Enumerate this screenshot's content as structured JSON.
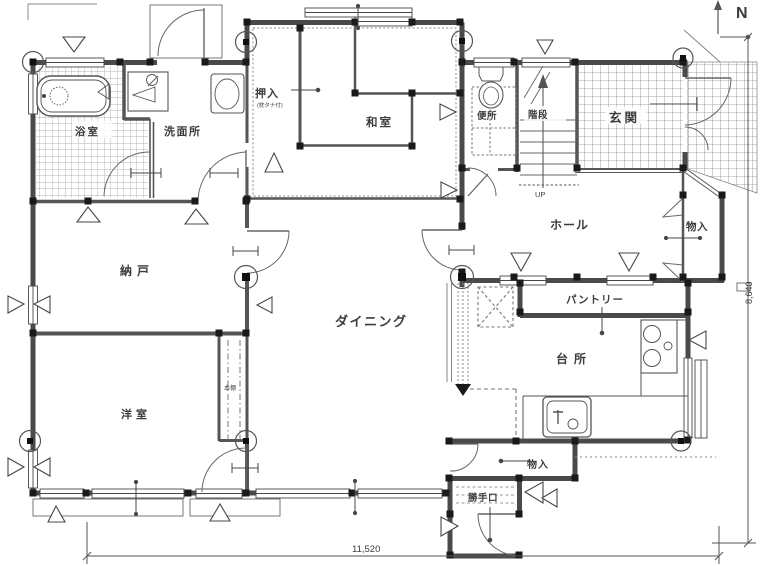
{
  "plan_title": "floor-plan",
  "north_label": "N",
  "rooms": {
    "bath": {
      "label": "浴室"
    },
    "washroom": {
      "label": "洗面所"
    },
    "oshiire": {
      "label": "押入"
    },
    "oshiire_note": {
      "label": "(枕タナ付)"
    },
    "washitsu": {
      "label": "和室"
    },
    "toilet": {
      "label": "便所"
    },
    "stairs": {
      "label": "階段"
    },
    "stairs_up": {
      "label": "UP"
    },
    "genkan": {
      "label": "玄関"
    },
    "hall": {
      "label": "ホール"
    },
    "storage_right": {
      "label": "物入"
    },
    "nando": {
      "label": "納戸"
    },
    "dining": {
      "label": "ダイニング"
    },
    "pantry": {
      "label": "パントリー"
    },
    "kitchen": {
      "label": "台所"
    },
    "yoshitsu": {
      "label": "洋室"
    },
    "bookshelf": {
      "label": "本棚"
    },
    "storage_bottom": {
      "label": "物入"
    },
    "backdoor": {
      "label": "勝手口"
    }
  },
  "dimensions": {
    "width_mm": "11,520",
    "height_mm": "8,640"
  },
  "fixtures": [
    "bathtub",
    "vanity-basin",
    "washing-machine",
    "toilet-bowl",
    "kitchen-sink",
    "stove-burners",
    "stairs-up-arrow",
    "north-arrow"
  ],
  "colors": {
    "wall": "#4a4a4a",
    "line": "#6a6a6a",
    "tile": "#9a9a9a",
    "paper": "#ffffff"
  }
}
